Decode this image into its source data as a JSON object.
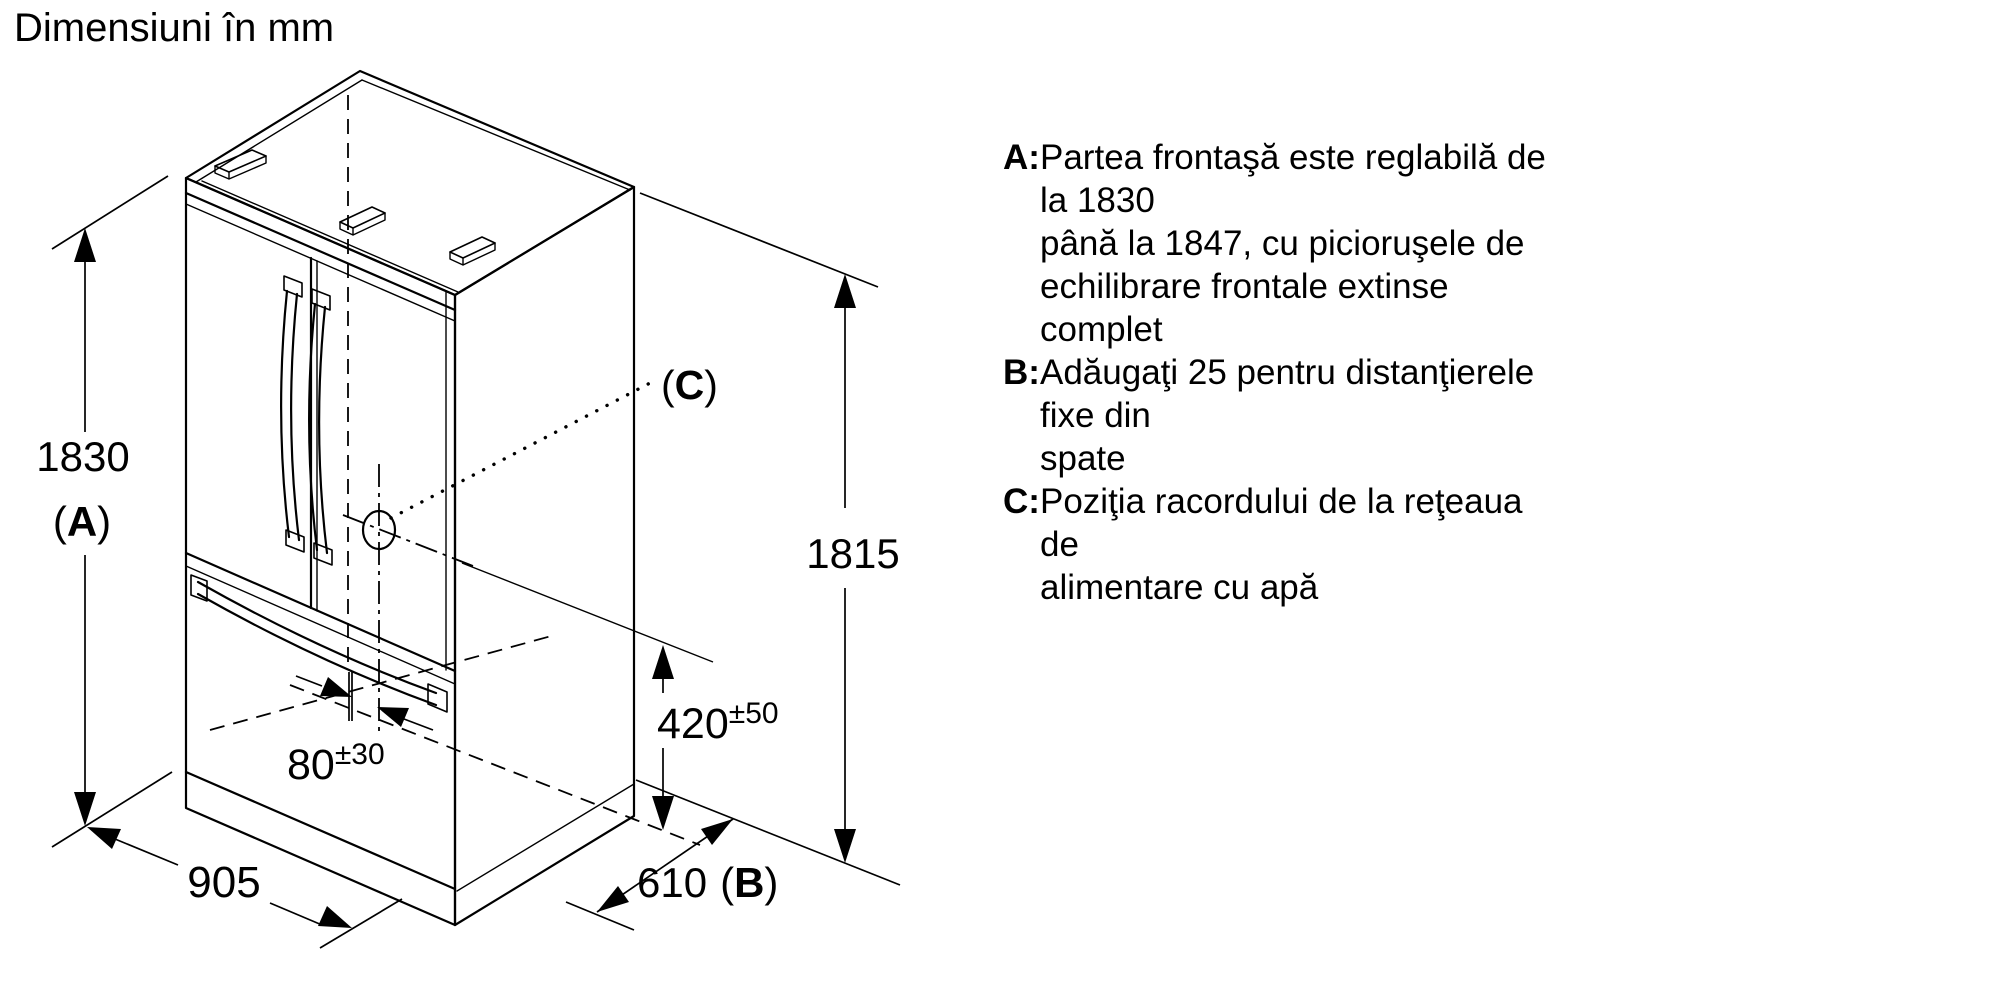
{
  "title": "Dimensiuni în mm",
  "symbols": {
    "paren_open": "(",
    "paren_close": ")"
  },
  "notes": [
    {
      "label": "A:",
      "lines": [
        "Partea frontaşă este reglabilă de la 1830",
        "până la 1847, cu picioruşele de",
        "echilibrare frontale extinse complet"
      ]
    },
    {
      "label": "B:",
      "lines": [
        "Adăugaţi 25 pentru distanţierele fixe din",
        "spate"
      ]
    },
    {
      "label": "C:",
      "lines": [
        "Poziţia racordului de la reţeaua de",
        "alimentare cu apă"
      ]
    }
  ],
  "dimensions": {
    "front_height": {
      "value": "1830",
      "ref_letter": "A"
    },
    "rear_height": {
      "value": "1815"
    },
    "width": {
      "value": "905"
    },
    "depth": {
      "value": "610",
      "ref_letter": "B"
    },
    "water_connection_height": {
      "value": "420",
      "tolerance": "±50"
    },
    "water_connection_offset": {
      "value": "80",
      "tolerance": "±30"
    },
    "water_connection_ref_letter": "C"
  },
  "colors": {
    "background": "#ffffff",
    "line": "#000000",
    "text": "#000000"
  }
}
